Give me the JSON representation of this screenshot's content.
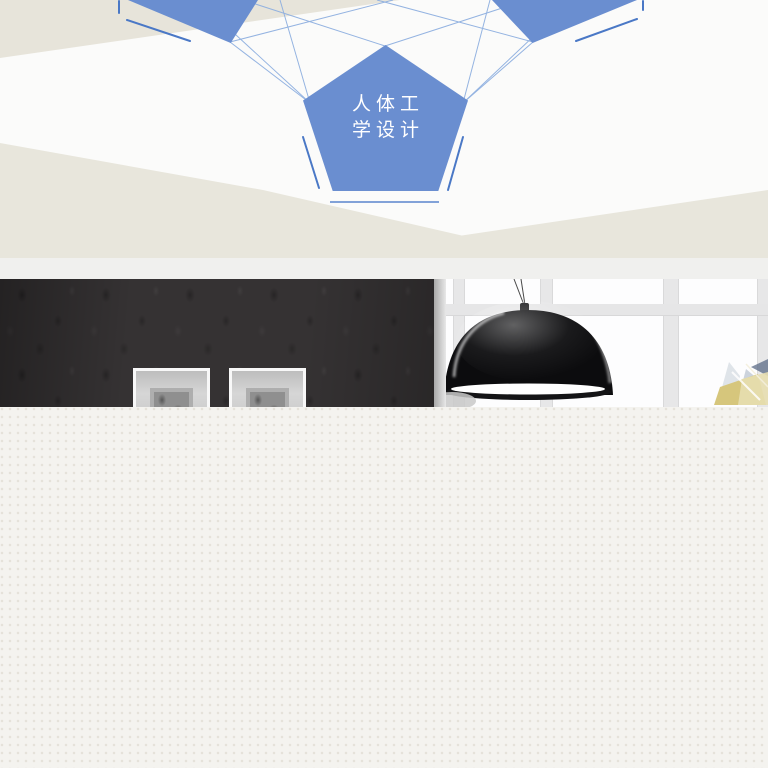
{
  "banner": {
    "type": "product-feature-promo-segment",
    "feature": {
      "label_full": "人体工学设计",
      "label_line1": "人体工",
      "label_line2": "学设计"
    },
    "colors": {
      "pentagon_blue": "#6a8ed0",
      "connector_blue": "#8fb0e0",
      "accent_blue": "#4a78c6",
      "wedge_beige": "#e8e6dc",
      "diagram_background": "#fbfbfa",
      "divider_gray": "#f0f0ee",
      "wall_charcoal": "#353233",
      "window_white": "#fdfdfe",
      "lamp_black": "#0c0c0e",
      "lamp_rim_white": "#ffffff",
      "crystal_yellow": "#d6c67c",
      "crystal_blue": "#b9c4d4",
      "footer_beige": "#f4f3ef"
    }
  }
}
